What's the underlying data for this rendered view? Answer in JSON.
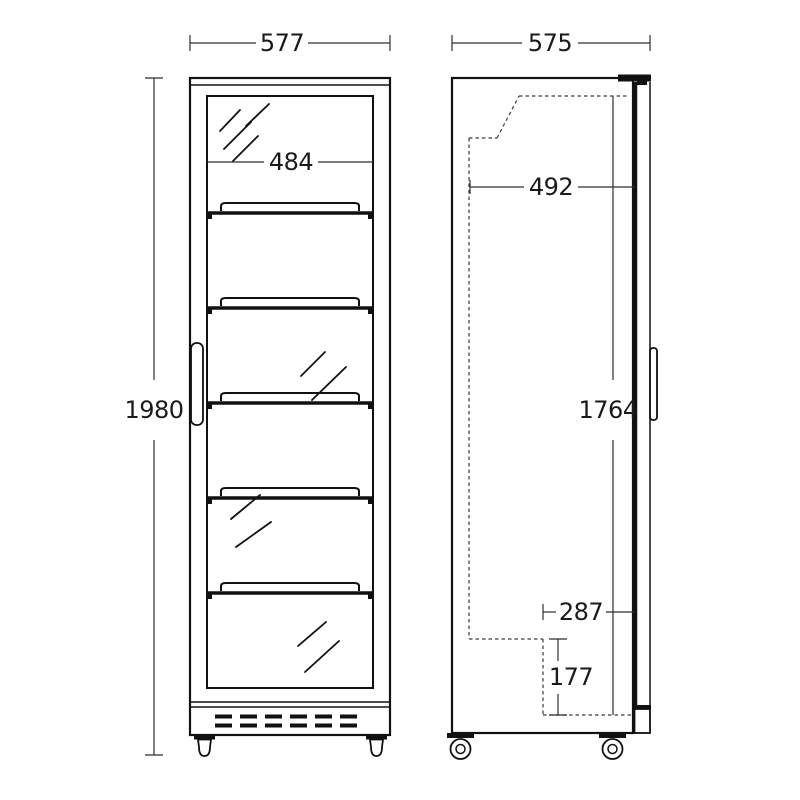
{
  "drawing": {
    "ink_color": "#111111",
    "background_color": "#ffffff",
    "front_view": {
      "overall_width": "577",
      "door_glass_width": "484",
      "overall_height": "1980",
      "shelf_count": 5
    },
    "side_view": {
      "overall_depth": "575",
      "interior_depth": "492",
      "interior_height": "1764",
      "lower_recess_depth": "287",
      "lower_recess_height": "177"
    }
  }
}
